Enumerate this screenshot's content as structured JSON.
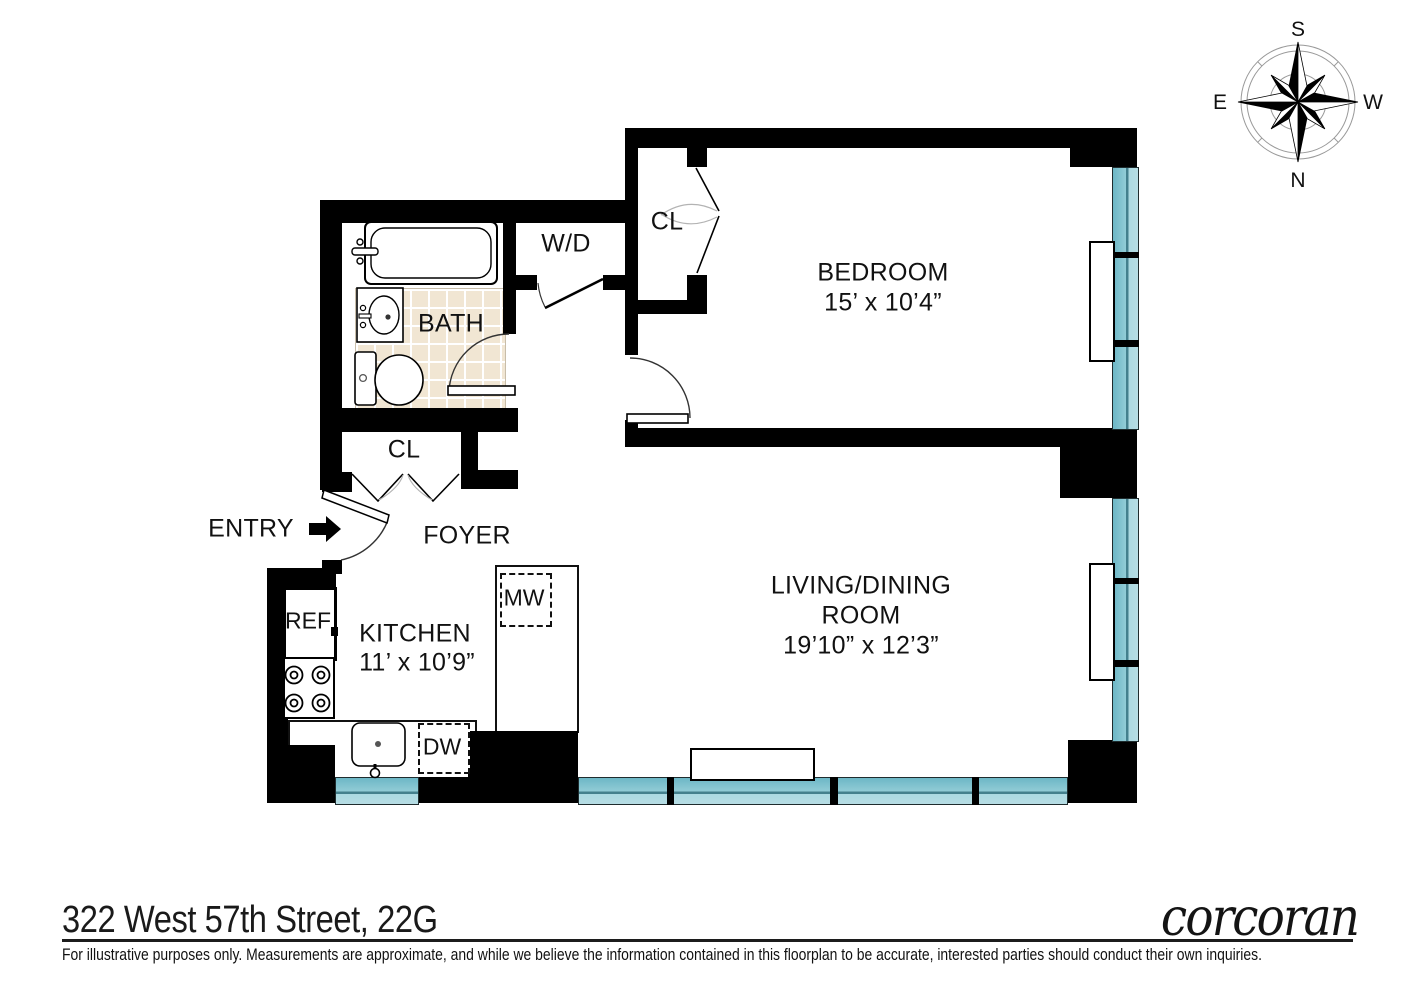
{
  "footer": {
    "address": "322 West 57th Street, 22G",
    "brand": "corcoran",
    "disclaimer": "For illustrative purposes only.  Measurements are approximate, and while we believe the information contained in this floorplan to be accurate, interested parties should conduct their own inquiries."
  },
  "compass": {
    "top": "S",
    "bottom": "N",
    "left": "E",
    "right": "W"
  },
  "rooms": {
    "bedroom": {
      "name": "BEDROOM",
      "dimensions": "15’ x 10’4”"
    },
    "living_dining": {
      "name_line1": "LIVING/DINING",
      "name_line2": "ROOM",
      "dimensions": "19’10” x 12’3”"
    },
    "kitchen": {
      "name": "KITCHEN",
      "dimensions": "11’ x 10’9”"
    },
    "bath": {
      "name": "BATH"
    },
    "foyer": {
      "name": "FOYER"
    },
    "entry": {
      "name": "ENTRY"
    },
    "washer_dryer": {
      "name": "W/D"
    },
    "bedroom_closet": {
      "name": "CL"
    },
    "foyer_closet": {
      "name": "CL"
    }
  },
  "appliances": {
    "refrigerator": "REF",
    "microwave": "MW",
    "dishwasher": "DW"
  },
  "colors": {
    "wall": "#000000",
    "window": "#7fc3d0",
    "window_light": "#abd9e1",
    "window_line": "#44808d",
    "tile": "#f1e6d3"
  }
}
